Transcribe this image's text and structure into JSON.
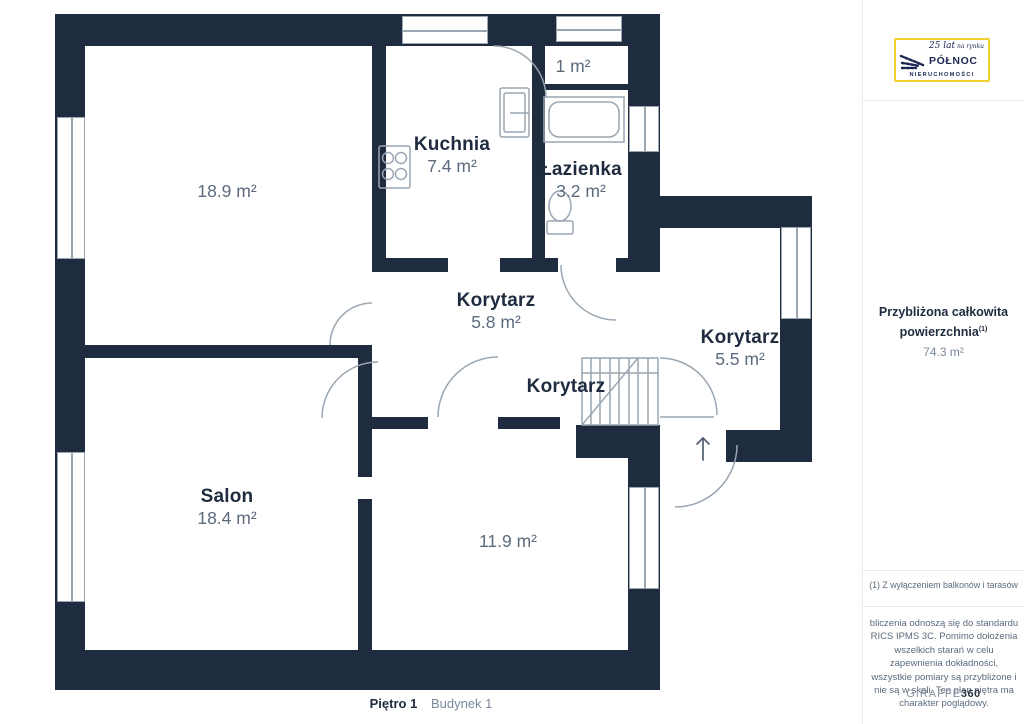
{
  "rooms": {
    "room_189": {
      "area": "18.9 m²"
    },
    "kuchnia": {
      "name": "Kuchnia",
      "area": "7.4 m²"
    },
    "wc": {
      "area": "1 m²"
    },
    "lazienka": {
      "name": "Łazienka",
      "area": "3.2 m²"
    },
    "korytarz_58": {
      "name": "Korytarz",
      "area": "5.8 m²"
    },
    "korytarz_55": {
      "name": "Korytarz",
      "area": "5.5 m²"
    },
    "korytarz_mid": {
      "name": "Korytarz"
    },
    "salon": {
      "name": "Salon",
      "area": "18.4 m²"
    },
    "room_119": {
      "area": "11.9 m²"
    }
  },
  "sidebar": {
    "logo": {
      "years": "25 lat",
      "years_suffix": " na rynku",
      "brand_top": "PÓŁNOC",
      "brand_bottom": "NIERUCHOMOŚCI"
    },
    "area_heading": "Przybliżona całkowita powierzchnia",
    "area_superscript": "(1)",
    "area_value": "74.3 m²",
    "footnote": "(1) Z wyłączeniem balkonów i tarasów",
    "disclaimer": "bliczenia odnoszą się do standardu RICS IPMS 3C. Pomimo dołożenia wszelkich starań w celu zapewnienia dokładności, wszystkie pomiary są przybliżone i nie są w skali. Ten plan piętra ma charakter poglądowy.",
    "watermark_brand": "GIRAFFE",
    "watermark_suffix": "360"
  },
  "footer": {
    "floor_label": "Piętro 1",
    "building_label": "Budynek 1"
  },
  "colors": {
    "wall": "#1f2b3f",
    "room_name": "#1f2b3f",
    "area_text": "#5c6b7e",
    "fixture_line": "#9aa6b2",
    "logo_border": "#f2d22e",
    "logo_navy": "#1b2653",
    "divider": "#e8eaee",
    "muted_text": "#5b6b7d",
    "value_text": "#7a8899",
    "arrow": "#4f5d70"
  }
}
